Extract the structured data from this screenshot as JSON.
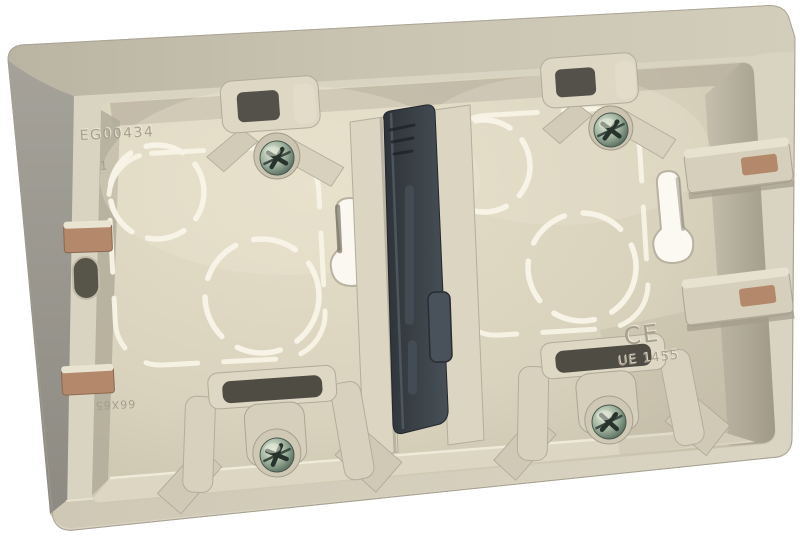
{
  "scene": {
    "description": "Product photo: beige two-gang surface-mounting wall box (back box) shown at a slight angle on a white background. Cream interior with two compartments separated by a dark charcoal centre divider, four green-tinted combi fixing screws on moulded bosses, dashed knock-out guide circles and rounded-square traces, keyhole fixing slots, and rectangular cable-entry knockouts on the side walls.",
    "background_color": "#ffffff",
    "screw_count": 4,
    "compartment_count": 2
  },
  "markings": {
    "product_code": "EG00434",
    "cavity_number": "1",
    "ce_mark": "CE",
    "approval_code": "UE 1455",
    "mold_code": "66X65"
  },
  "colors": {
    "body_beige": "#d7d1bf",
    "top_face_beige": "#c8c2b0",
    "side_grey": "#99968e",
    "interior_cream": "#ddd6c1",
    "inner_wall_shadow": "#aaa391",
    "divider_charcoal": "#3a4147",
    "screw_green_metal": "#6e8172",
    "knockout_tan": "#b4886a",
    "dash_guide_cream": "#f7f3e6"
  }
}
